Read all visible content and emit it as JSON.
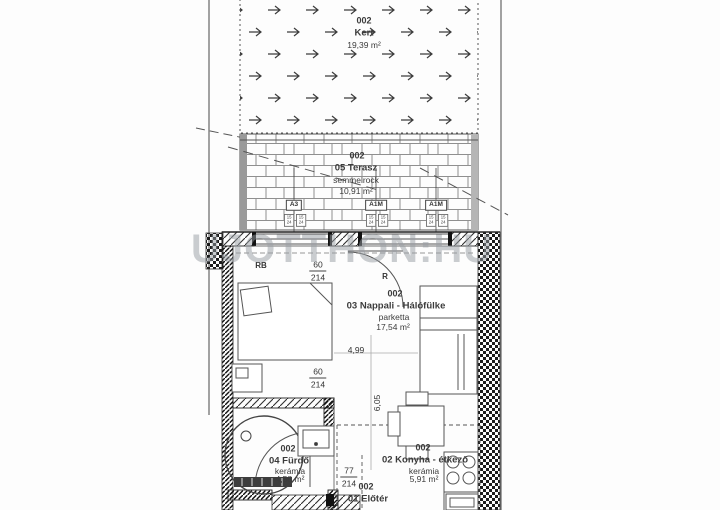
{
  "watermark": "UJOTTHON:HU",
  "rooms": {
    "garden": {
      "no": "002",
      "name": "Kert",
      "area": "19,39 m²"
    },
    "terrace": {
      "no": "002",
      "name": "05 Terasz",
      "floor": "semmelrock",
      "area": "10,91 m²"
    },
    "living": {
      "no": "002",
      "name": "03 Nappali - Hálófülke",
      "floor": "parketta",
      "area": "17,54 m²"
    },
    "bathroom": {
      "no": "002",
      "name": "04 Fürdő",
      "floor": "kerámia",
      "area": "4,58 m²"
    },
    "kitchen": {
      "no": "002",
      "name": "02 Konyha - étkező",
      "floor": "kerámia",
      "area": "5,91 m²"
    },
    "hall": {
      "no": "002",
      "name": "01 Előtér"
    }
  },
  "windows": [
    {
      "label": "A3",
      "sill_top": "15",
      "sill_bottom": "24"
    },
    {
      "label": "A1M",
      "sill_top": "15",
      "sill_bottom": "24"
    },
    {
      "label": "A1M",
      "sill_top": "15",
      "sill_bottom": "24"
    }
  ],
  "dims": {
    "terrace_door_mark": "RB",
    "terrace_door_w": "60",
    "terrace_door_h": "214",
    "room_door_mark": "R",
    "bath_door_w": "60",
    "bath_door_h": "214",
    "entry_door_w": "77",
    "entry_door_h": "214",
    "living_width": "4,99",
    "living_depth": "6,05"
  },
  "colors": {
    "line": "#3f3f3f",
    "wall": "#1a1a1a",
    "watermark": "#979da3"
  }
}
